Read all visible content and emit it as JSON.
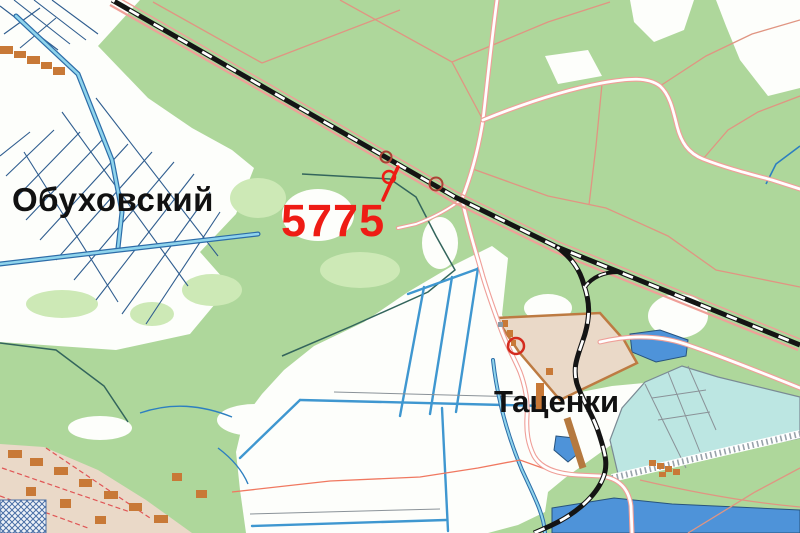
{
  "map": {
    "kind": "topographic map",
    "labels": {
      "settlement_left": "Обуховский",
      "settlement_right": "Таценки",
      "marker": "5775"
    },
    "palette": {
      "forest_green": "#aed79b",
      "light_green": "#cde9b6",
      "field_white": "#fdfefb",
      "water_blue": "#4e93d9",
      "pond_cyan": "#bce6e2",
      "channel_blue": "#3f97d0",
      "railway_black": "#141414",
      "road_casing": "#ef9f98",
      "trail_salmon": "#e09582",
      "built_up_tan": "#ead9c8",
      "building_orange": "#c87937",
      "marker_red": "#ee1c15",
      "waypoint_dark_red": "#aa4435",
      "boundary_teal": "#33655c"
    }
  }
}
